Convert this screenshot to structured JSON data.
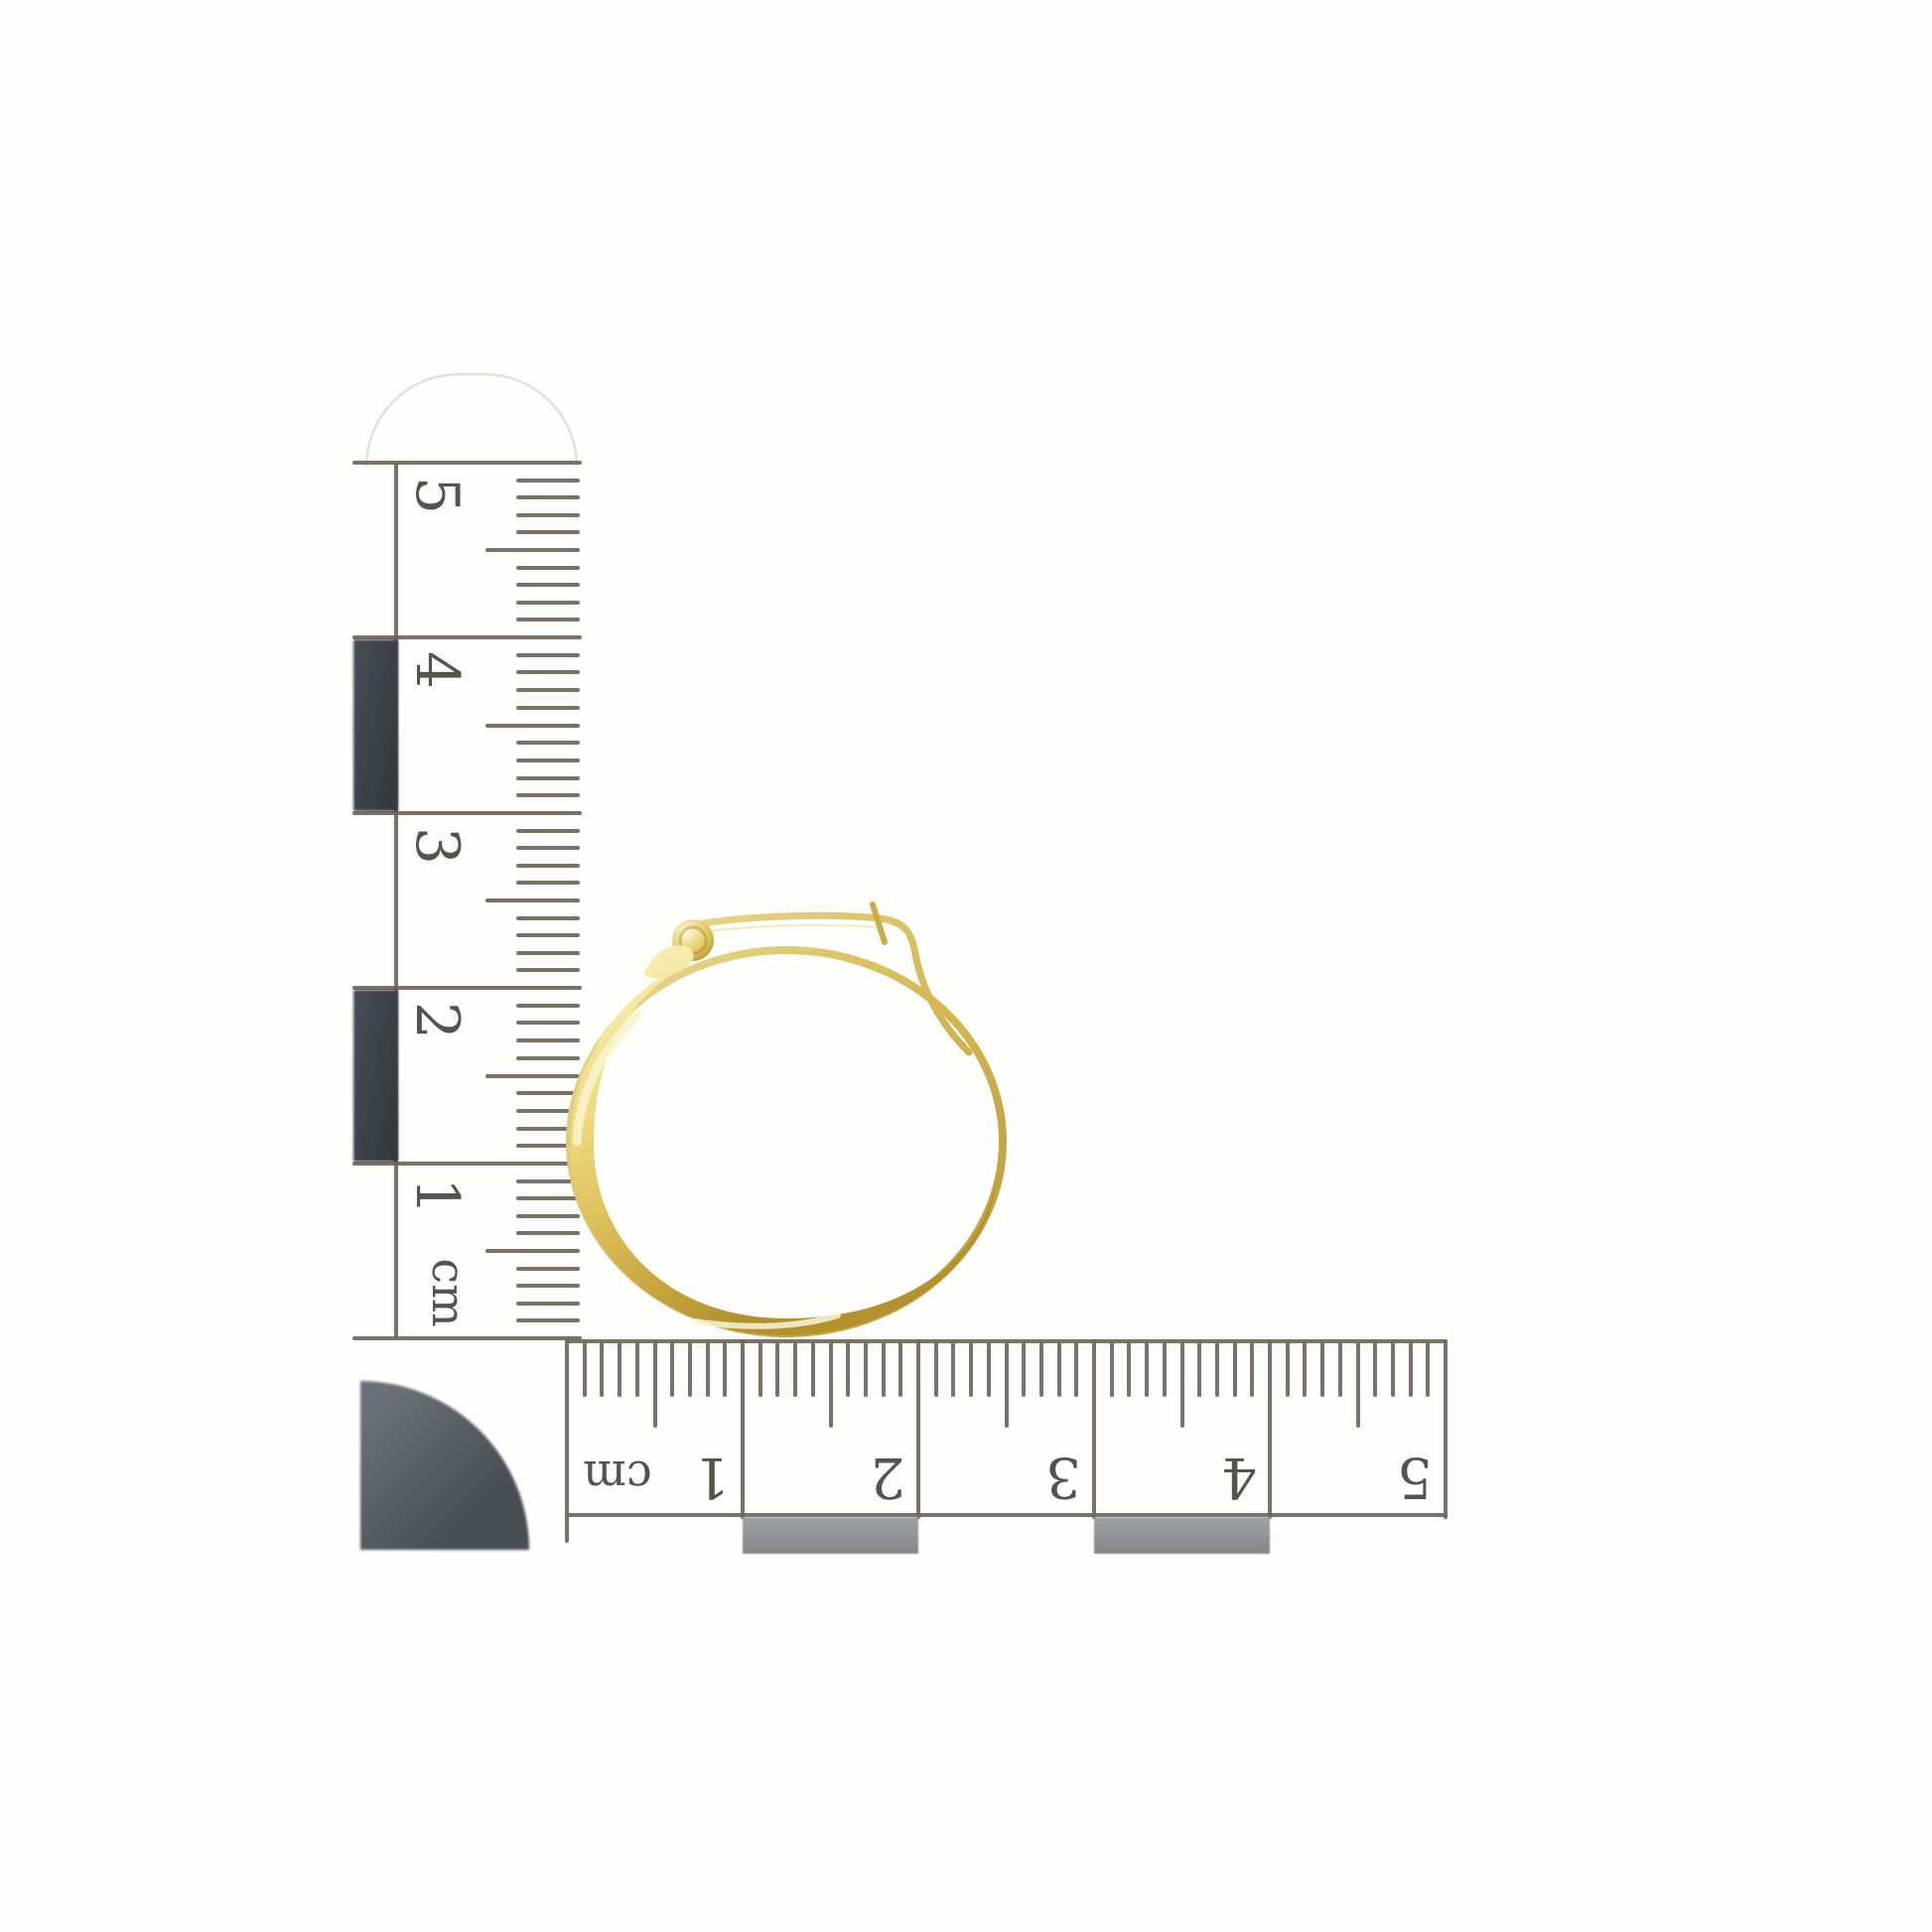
{
  "photo": {
    "subject_icon": "gold-hoop-earring-icon",
    "background_color": "#fdfdfb"
  },
  "vertical_ruler": {
    "unit_label": "cm",
    "tick_labels": [
      "5",
      "4",
      "3",
      "2",
      "1"
    ]
  },
  "horizontal_ruler": {
    "unit_label": "cm",
    "tick_labels": [
      "1",
      "2",
      "3",
      "4",
      "5"
    ]
  },
  "colors": {
    "ink_line": "#6f6659",
    "digit_ink": "#57524a",
    "checker_dark": "#41464d",
    "checker_gray": "#8f9296",
    "corner_disc": "#575d64",
    "gold_highlight": "#f9f3cc",
    "gold_mid": "#ddc05a",
    "gold_deep": "#a8871f"
  }
}
